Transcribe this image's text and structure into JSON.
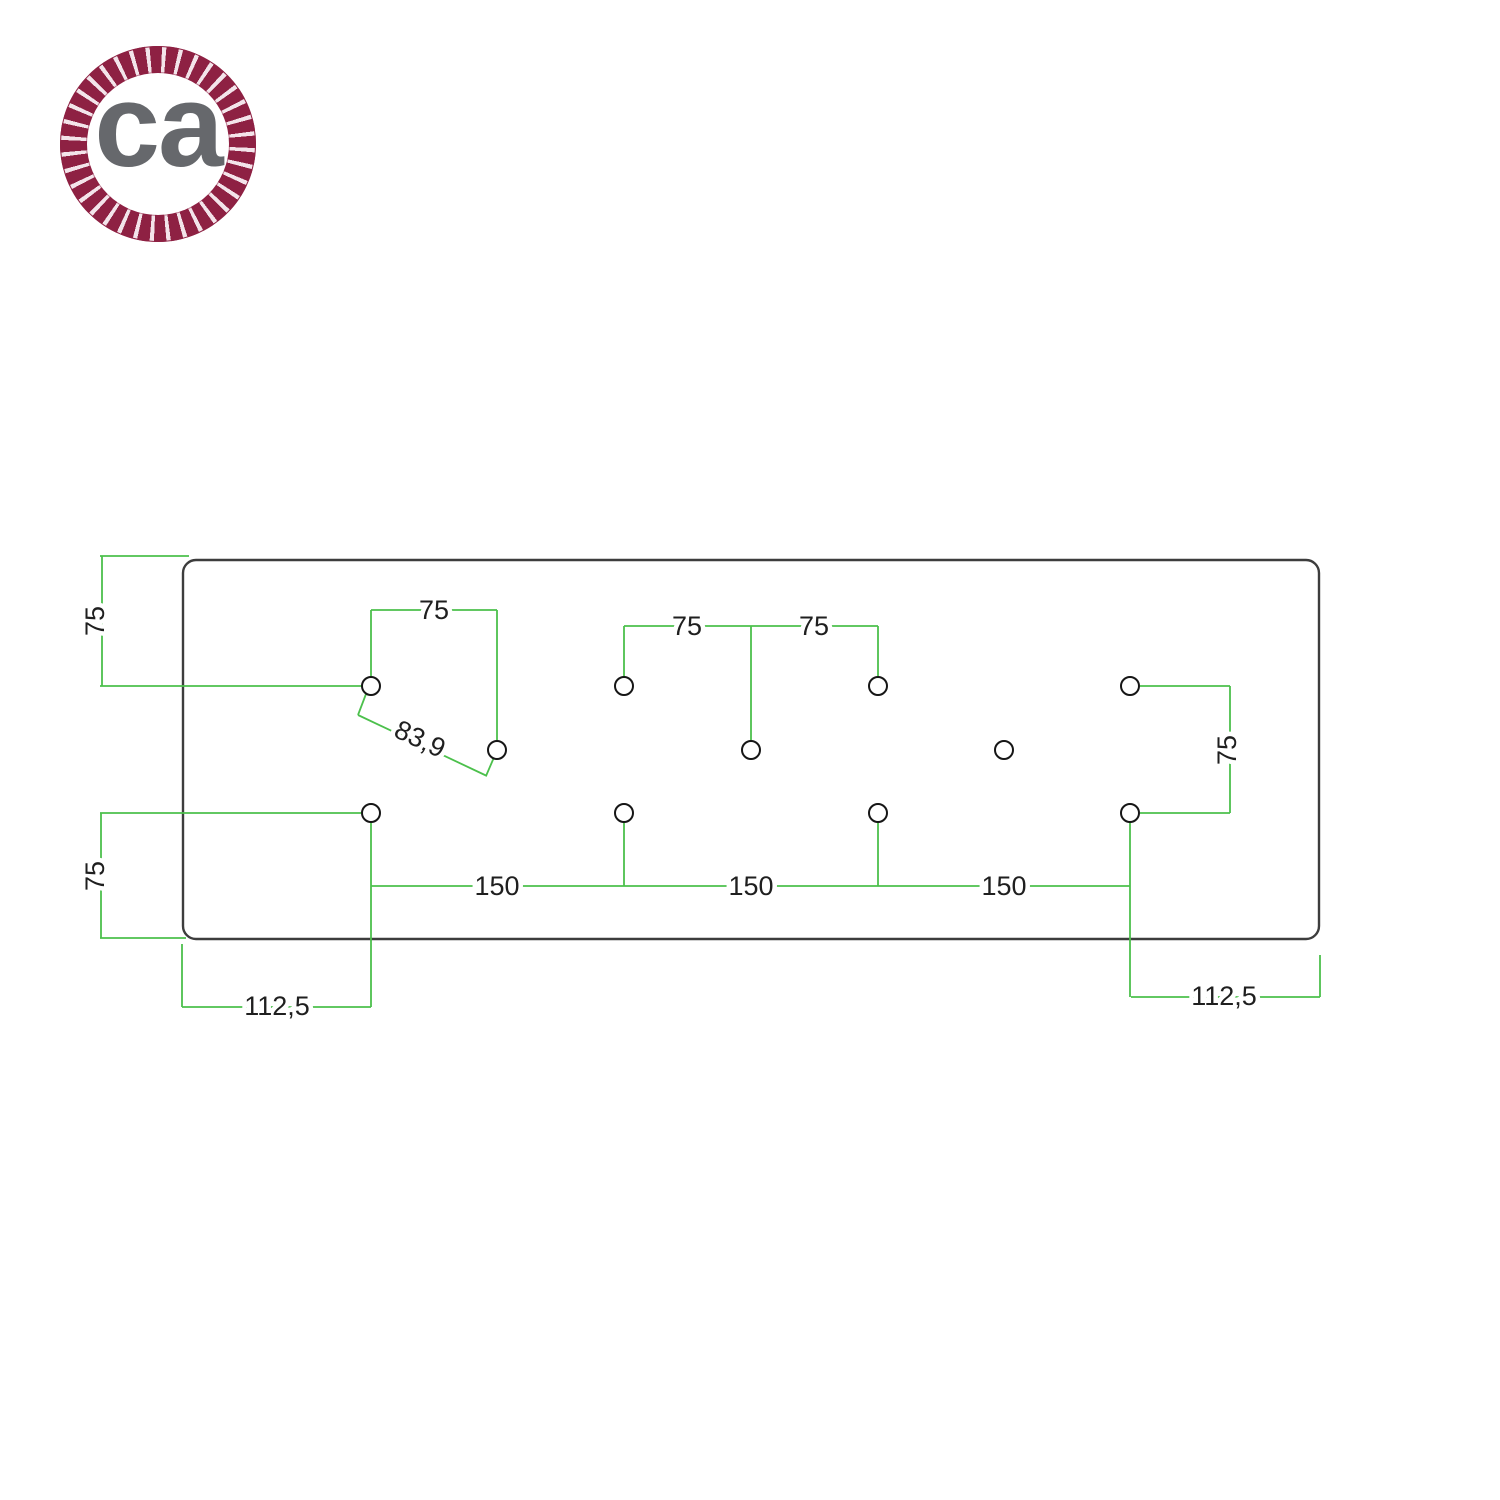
{
  "logo": {
    "text": "ca",
    "rope_color": "#8e2143",
    "text_color": "#66686c"
  },
  "drawing": {
    "colors": {
      "dimension_green": "#4cc04c",
      "plate_outline": "#3d3d3d",
      "hole_outline": "#161616",
      "label_text": "#1f1f1f"
    },
    "labels": {
      "left_top": "75",
      "hole1_top": "75",
      "diagonal": "83,9",
      "mid_left": "75",
      "mid_right": "75",
      "right_side": "75",
      "left_bottom": "75",
      "span1": "150",
      "span2": "150",
      "span3": "150",
      "offset_left": "112,5",
      "offset_right": "112,5"
    }
  }
}
